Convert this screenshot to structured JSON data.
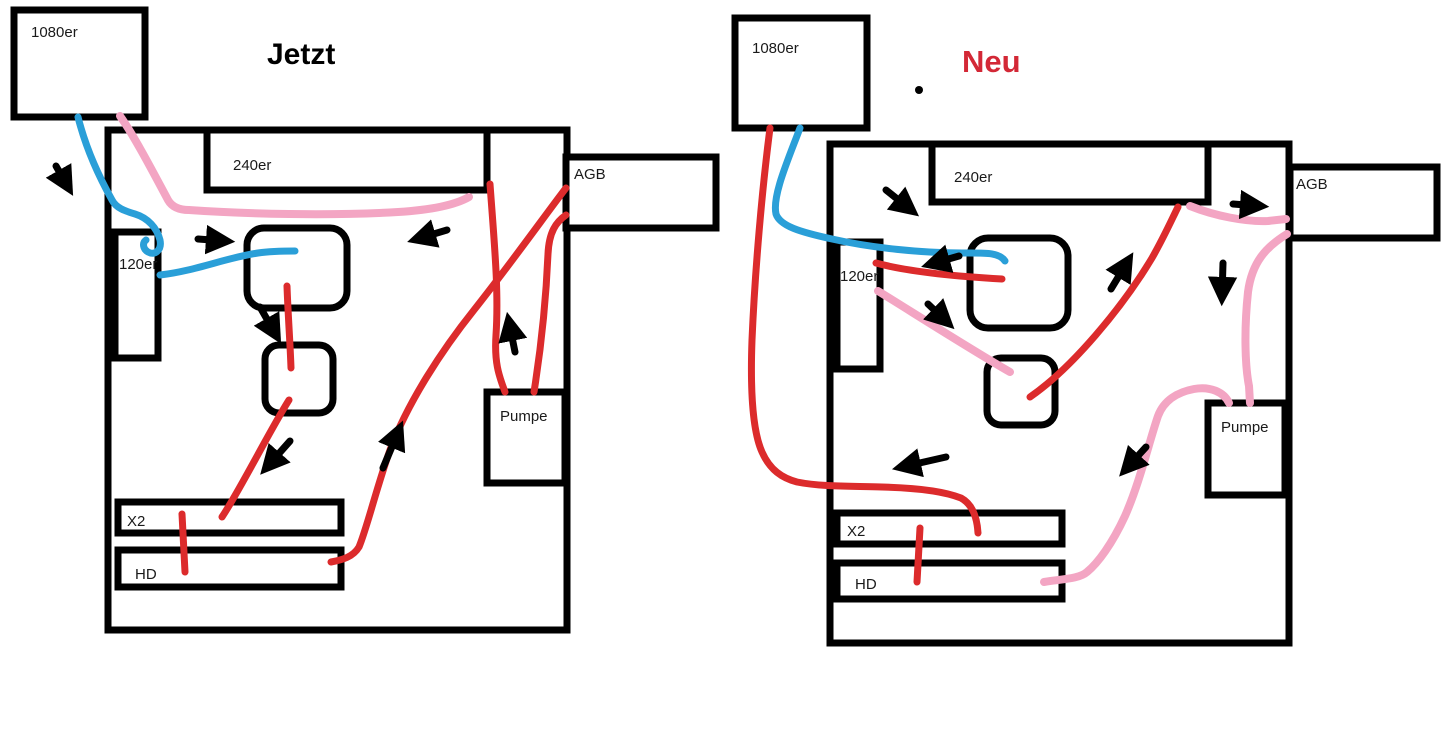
{
  "colors": {
    "outline": "#000000",
    "blue": "#2a9fd8",
    "pink": "#f3a5c3",
    "red": "#dc2b2c",
    "neu": "#d32836",
    "label": "#1a1a1a"
  },
  "diagrams": {
    "left": {
      "title": "Jetzt",
      "labels": {
        "r1080": "1080er",
        "r240": "240er",
        "agb": "AGB",
        "r120": "120er",
        "pump": "Pumpe",
        "x2": "X2",
        "hd": "HD"
      }
    },
    "right": {
      "title": "Neu",
      "labels": {
        "r1080": "1080er",
        "r240": "240er",
        "agb": "AGB",
        "r120": "120er",
        "pump": "Pumpe",
        "x2": "X2",
        "hd": "HD"
      }
    }
  }
}
